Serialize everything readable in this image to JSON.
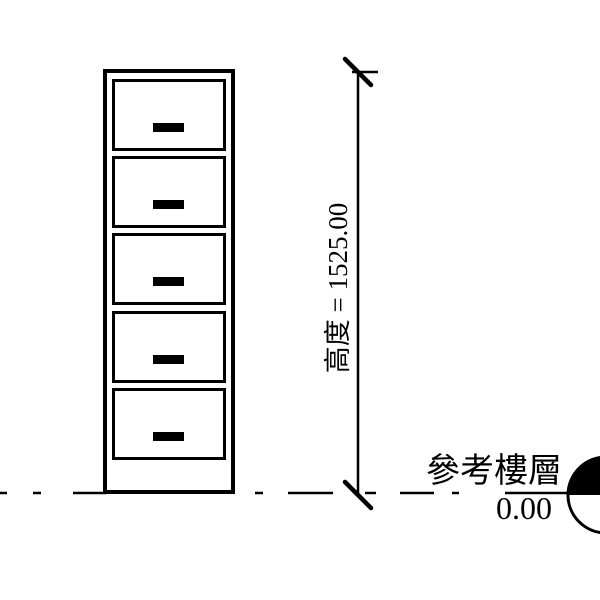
{
  "drawing": {
    "type": "cad-elevation",
    "description": "five-drawer filing cabinet elevation",
    "background_color": "#ffffff",
    "line_color": "#000000",
    "cabinet": {
      "drawer_count": 5
    },
    "dimension": {
      "text": "高度 = 1525.00",
      "label": "高度",
      "value": "1525.00"
    },
    "reference_level": {
      "label": "參考樓層",
      "elevation": "0.00"
    }
  }
}
